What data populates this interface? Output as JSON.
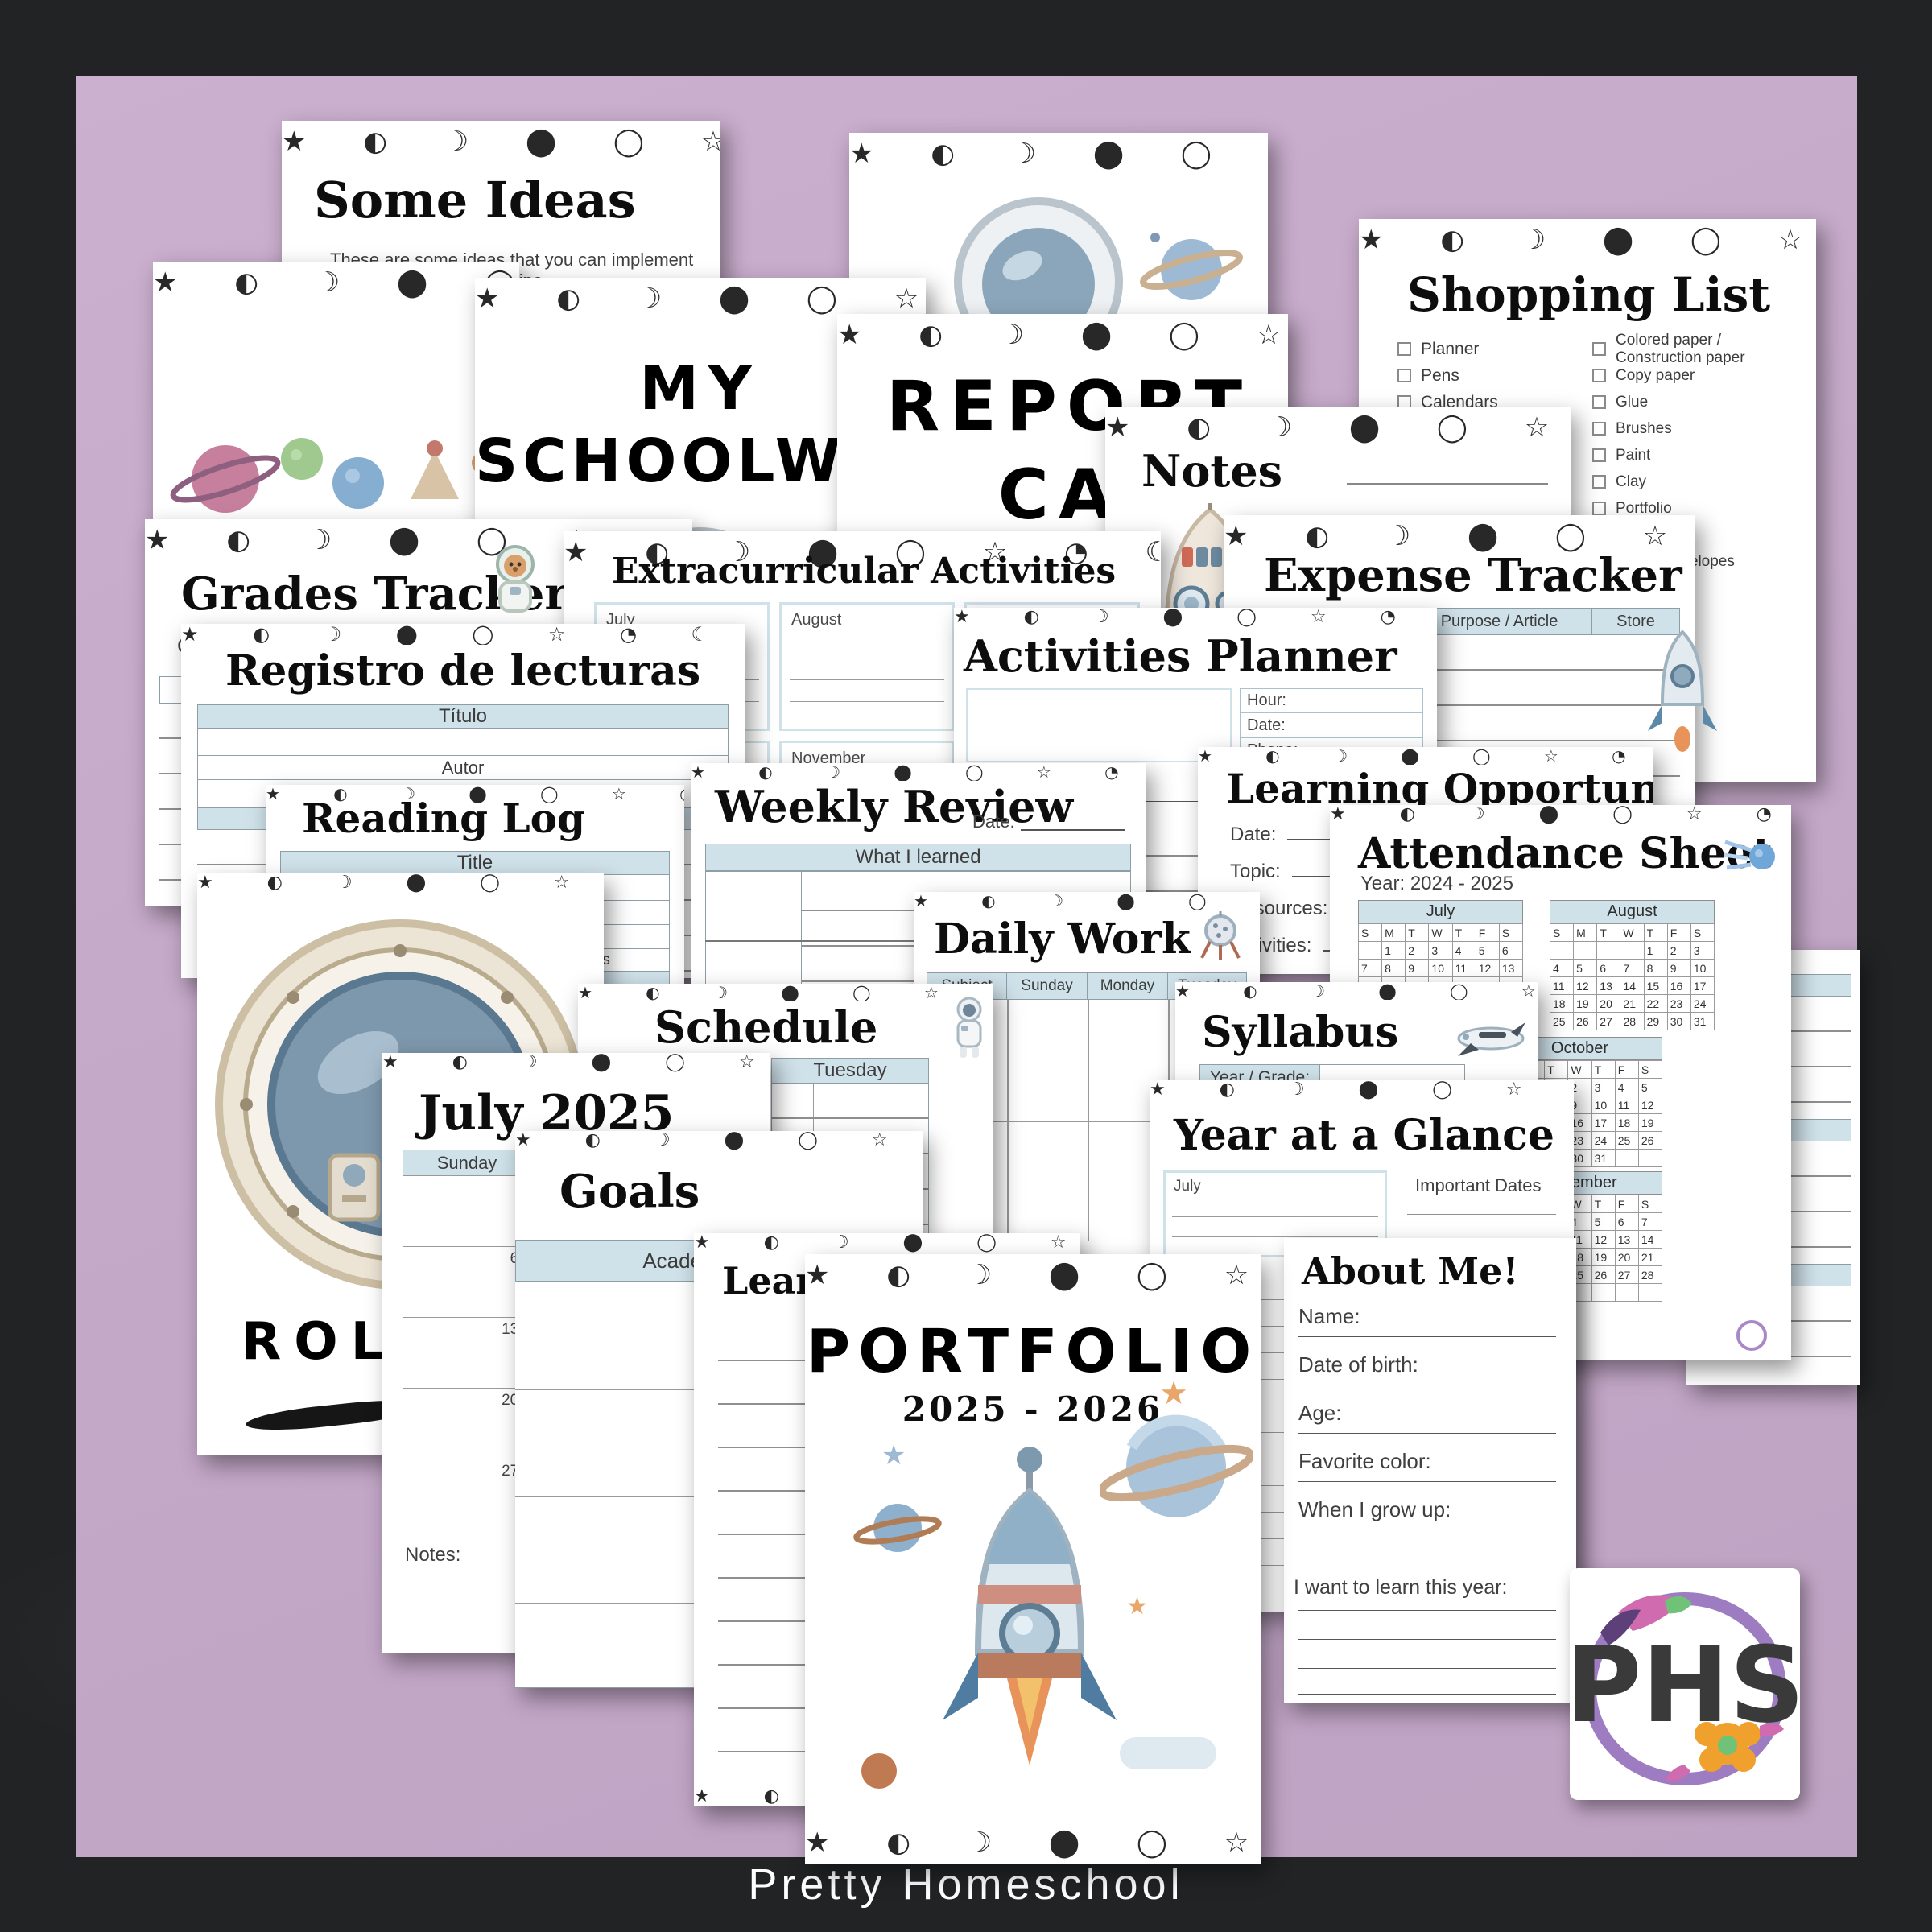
{
  "footer": {
    "brand": "Pretty Homeschool"
  },
  "logo": {
    "monogram": "PHS"
  },
  "colors": {
    "accent_blue": "#cfe1e9",
    "mat_purple": "#c4a9c8",
    "no_school_red": "#e04a32"
  },
  "pages": {
    "some_ideas": {
      "title": "Some Ideas",
      "intro": "These are some ideas that you can implement in your homeschool routine.",
      "bullets": [
        "Interviews",
        "Monographies",
        "Lapbooking",
        "Interactive Notebook",
        "Test",
        "Quizzes"
      ]
    },
    "my_schoolwork": {
      "line1": "MY",
      "line2": "SCHOOLWORK"
    },
    "report_card": {
      "line1": "REPORT",
      "line2": "CARD"
    },
    "shopping_list": {
      "title": "Shopping List",
      "column1": [
        "Planner",
        "Pens",
        "Calendars",
        "3 Ring binders",
        "Laminating folders",
        "Folders",
        "Cardstock",
        "Tape"
      ],
      "column2": [
        "Colored paper / Construction paper",
        "Copy paper",
        "Glue",
        "Brushes",
        "Paint",
        "Clay",
        "Portfolio",
        "Sharpener",
        "Manila envelopes",
        "Index cards",
        "Scissors",
        "Printer ink",
        "Other:"
      ]
    },
    "notes": {
      "title": "Notes"
    },
    "grades_tracker": {
      "title": "Grades Tracker",
      "grade_year_label": "Grade / Year:",
      "subject_label": "Subject:",
      "table_header": "Grades / Points"
    },
    "extracurricular": {
      "title": "Extracurricular Activities",
      "months": [
        "July",
        "August",
        "September",
        "October",
        "November",
        "December"
      ]
    },
    "expense_tracker": {
      "title": "Expense Tracker",
      "headers": [
        "Date",
        "Amount",
        "Purpose / Article",
        "Store"
      ]
    },
    "registro": {
      "title": "Registro de lecturas",
      "titulo_header": "Título",
      "autor_header": "Autor"
    },
    "activities_planner": {
      "title": "Activities Planner",
      "hour_label": "Hour:",
      "date_label": "Date:",
      "phone_label": "Phone:",
      "contact_label": "Contact:",
      "bring_label": "Take / Bring:"
    },
    "reading_log": {
      "title": "Reading Log",
      "title_header": "Title",
      "author_header": "Author",
      "pages_header": "Pages"
    },
    "weekly_review": {
      "title": "Weekly Review",
      "date_label": "Date:",
      "header": "What I learned"
    },
    "learning_opportunities": {
      "title": "Learning Opportunities",
      "fields": [
        "Date:",
        "Topic:",
        "Resources:",
        "Activities:"
      ]
    },
    "attendance": {
      "title": "Attendance Sheet",
      "year_label": "Year: 2024 - 2025",
      "day_letters": [
        "S",
        "M",
        "T",
        "W",
        "T",
        "F",
        "S"
      ],
      "months": [
        {
          "name": "July",
          "rows": [
            [
              "",
              "1",
              "2",
              "3",
              "4",
              "5",
              "6"
            ],
            [
              "7",
              "8",
              "9",
              "10",
              "11",
              "12",
              "13"
            ],
            [
              "14",
              "15",
              "16",
              "17",
              "18",
              "19",
              "20"
            ],
            [
              "21",
              "22",
              "23",
              "24",
              "25",
              "26",
              "27"
            ],
            [
              "28",
              "29",
              "30",
              "31",
              "",
              "",
              ""
            ]
          ]
        },
        {
          "name": "August",
          "rows": [
            [
              "",
              "",
              "",
              "",
              "1",
              "2",
              "3"
            ],
            [
              "4",
              "5",
              "6",
              "7",
              "8",
              "9",
              "10"
            ],
            [
              "11",
              "12",
              "13",
              "14",
              "15",
              "16",
              "17"
            ],
            [
              "18",
              "19",
              "20",
              "21",
              "22",
              "23",
              "24"
            ],
            [
              "25",
              "26",
              "27",
              "28",
              "29",
              "30",
              "31"
            ]
          ]
        },
        {
          "name": "October",
          "rows": [
            [
              "",
              "",
              "1",
              "2",
              "3",
              "4",
              "5"
            ],
            [
              "6",
              "7",
              "8",
              "9",
              "10",
              "11",
              "12"
            ],
            [
              "13",
              "14",
              "15",
              "16",
              "17",
              "18",
              "19"
            ],
            [
              "20",
              "21",
              "22",
              "23",
              "24",
              "25",
              "26"
            ],
            [
              "27",
              "28",
              "29",
              "30",
              "31",
              "",
              ""
            ]
          ]
        },
        {
          "name": "December",
          "rows": [
            [
              "1",
              "2",
              "3",
              "4",
              "5",
              "6",
              "7"
            ],
            [
              "8",
              "9",
              "10",
              "11",
              "12",
              "13",
              "14"
            ],
            [
              "15",
              "16",
              "17",
              "18",
              "19",
              "20",
              "21"
            ],
            [
              "22",
              "23",
              "24",
              "25",
              "26",
              "27",
              "28"
            ],
            [
              "29",
              "30",
              "31",
              "",
              "",
              "",
              ""
            ]
          ]
        }
      ],
      "no_school": "No School",
      "birthdays_label": "Birthdays:"
    },
    "roll_call": {
      "title_visible": "ROLL"
    },
    "daily_work": {
      "title": "Daily Work",
      "headers": [
        "Subject",
        "Sunday",
        "Monday",
        "Tuesday"
      ]
    },
    "schedule": {
      "title": "Schedule",
      "day1": "Monday",
      "day2": "Tuesday"
    },
    "syllabus": {
      "title": "Syllabus",
      "year_grade_label": "Year / Grade:",
      "subject_header": "Subject",
      "guide_header": "Guide Book / Curriculum"
    },
    "july_2025": {
      "title": "July 2025",
      "day_headers": [
        "Sunday",
        "Monday",
        "Tuesday",
        "Wednesday"
      ],
      "rows": [
        [
          "",
          "",
          "1"
        ],
        [
          "6",
          "7",
          ""
        ],
        [
          "13",
          "14",
          ""
        ],
        [
          "20",
          "21",
          ""
        ],
        [
          "27",
          "28",
          ""
        ]
      ],
      "notes_label": "Notes:"
    },
    "year_at_a_glance": {
      "title": "Year at a Glance",
      "month_label": "July",
      "important_dates_label": "Important Dates"
    },
    "goals": {
      "title": "Goals",
      "header": "Academic Goals"
    },
    "learning_plan": {
      "title": "Learning Plan"
    },
    "about_me": {
      "title": "About Me!",
      "name_label": "Name:",
      "dob_label": "Date of birth:",
      "age_label": "Age:",
      "color_label": "Favorite color:",
      "growup_label": "When I grow up:",
      "learn_label": "I want to learn this year:"
    },
    "portfolio": {
      "title": "PORTFOLIO",
      "years": "2025 - 2026"
    }
  }
}
